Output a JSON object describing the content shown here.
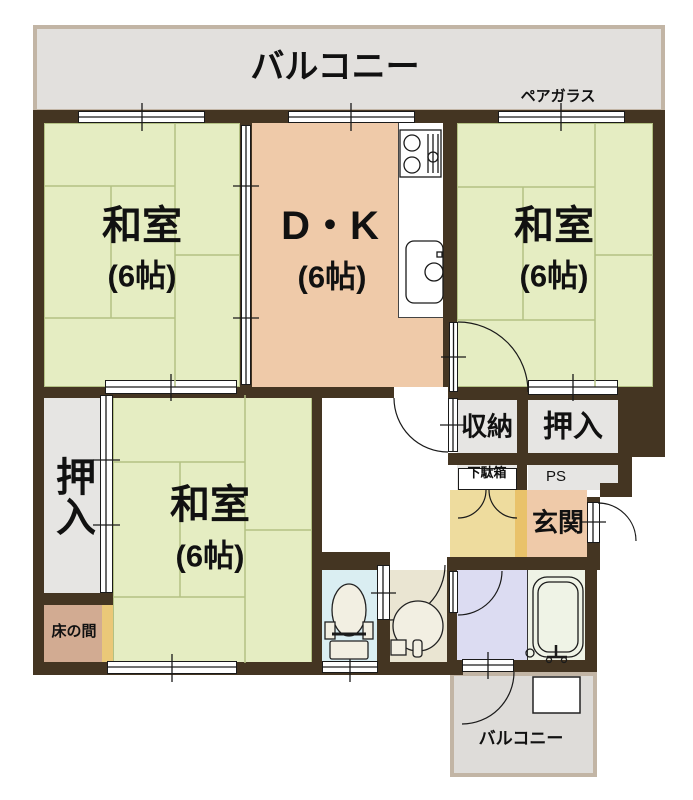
{
  "balcony_top": {
    "label": "バルコニー"
  },
  "pair_glass_note": "ペアガラス",
  "rooms": {
    "washitsu_tl": {
      "name": "和室",
      "size": "(6帖)"
    },
    "dk": {
      "name": "D・K",
      "size": "(6帖)"
    },
    "washitsu_tr": {
      "name": "和室",
      "size": "(6帖)"
    },
    "washitsu_bl": {
      "name": "和室",
      "size": "(6帖)"
    },
    "oshiire_left": {
      "label": "押入"
    },
    "oshiire_right": {
      "label": "押入"
    },
    "shuno": {
      "label": "収納"
    },
    "getabako": {
      "label": "下駄箱"
    },
    "ps": {
      "label": "PS"
    },
    "genkan": {
      "label": "玄関"
    },
    "tokonoma": {
      "label": "床の間"
    },
    "balcony_bottom": {
      "label": "バルコニー"
    }
  },
  "colors": {
    "wall": "#443522",
    "line": "#1a1a1a",
    "text": "#111111",
    "tatami": "#e5edc2",
    "tatami_line": "#b3c183",
    "dk": "#efcaa9",
    "closet": "#e6e5e3",
    "balcony_fill": "#e2e0dd",
    "balcony_border": "#c2b5a5",
    "hall_yellow": "#eedc9e",
    "step_orange": "#e9c26a",
    "toilet_blue": "#daeef2",
    "wash_beige": "#eae5d2",
    "bath_lavender": "#dcdcf2",
    "bath_pale": "#eff3e6",
    "tokonoma_tan": "#d2ab92",
    "toko_strip": "#eac878"
  }
}
